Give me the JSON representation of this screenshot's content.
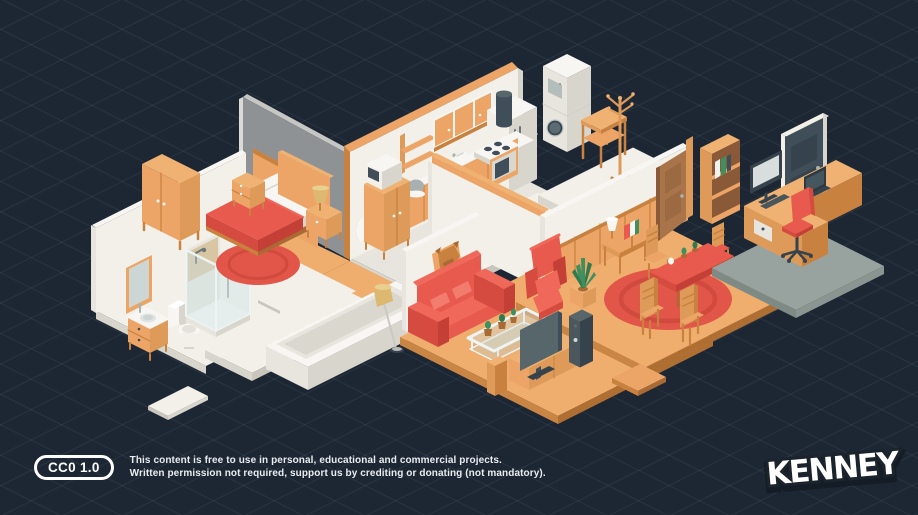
{
  "footer": {
    "badge": "CC0 1.0",
    "line1": "This content is free to use in personal, educational and commercial projects.",
    "line2": "Written permission not required, support us by crediting or donating (not mandatory).",
    "brand": "KENNEY"
  },
  "colors": {
    "background": "#1d2733",
    "floor_wood": "#efae6d",
    "wood": "#eca566",
    "accent_red": "#e85a4d",
    "rug_red": "#e25549",
    "wall_white": "#f2f0e9",
    "wall_gray": "#8e9295",
    "mat_gray": "#98a39f",
    "plant_green": "#3f8f5f",
    "dark_slate": "#3f4e59",
    "text": "#ffffff"
  },
  "scene": {
    "items": [
      "bedroom-floor",
      "kitchen-floor",
      "gray-wall",
      "kitchen-wall",
      "kitchen-upper-cabinets",
      "fridge-unit",
      "kitchen-counter",
      "tall-cabinet-microwave",
      "hall-floor",
      "utility-platform",
      "washer-dryer-stack",
      "utility-table",
      "coat-rack",
      "connector-floor",
      "bathroom-floor",
      "bathroom-wall-mirror",
      "bathroom-vanity",
      "toilet",
      "shower-stall",
      "bathtub",
      "bath-mat",
      "loose-tile",
      "bedroom-rug",
      "double-bed",
      "nightstand-left",
      "nightstand-lamp",
      "wardrobe",
      "hall-wall",
      "living-floor",
      "dining-floor",
      "dining-rug",
      "dining-wall",
      "dining-door",
      "bookshelf",
      "side-desk",
      "dining-chair-back-left",
      "dining-chair-back-right",
      "dining-table",
      "dining-chair-front-left",
      "dining-chair-front-right",
      "office-door",
      "office-mat",
      "office-desk",
      "office-chair",
      "living-wall-trophy",
      "sofa",
      "floor-lamp",
      "coffee-table",
      "armchair",
      "potted-plant",
      "tv-stand",
      "tv",
      "speaker",
      "loose-plank"
    ]
  }
}
